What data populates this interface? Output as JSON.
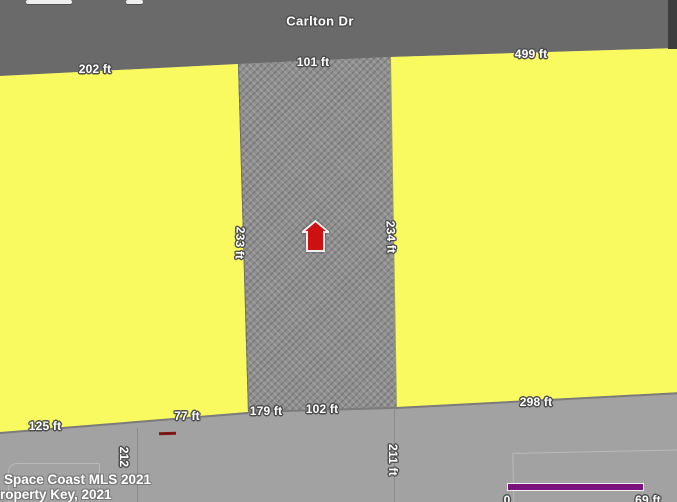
{
  "map": {
    "street": {
      "name": "Carlton Dr"
    },
    "measurements": {
      "top_left": "202 ft",
      "top_center": "101 ft",
      "top_right": "499 ft",
      "side_left": "233 ft",
      "side_right": "234 ft",
      "bottom_far_left": "125 ft",
      "bottom_left": "77 ft",
      "bottom_center_left": "179 ft",
      "bottom_center_right": "102 ft",
      "bottom_right": "298 ft",
      "lower_left_vertical": "212",
      "lower_center_vertical": "211 ft"
    },
    "watermark": {
      "line1": "Space Coast MLS 2021",
      "line2": "Property Key, 2021"
    },
    "scale_bar": {
      "min_label": "0",
      "max_label": "69 ft"
    },
    "colors": {
      "road_gray": "#6a6a6a",
      "parcel_yellow": "#f9f960",
      "hatched_parcel_gray": "#8f8f8f",
      "ground_gray": "#a2a2a2",
      "house_marker_red": "#cc1111",
      "scale_bar_purple": "#7c107c",
      "label_text": "#ffffff"
    },
    "icons": {
      "house_marker": "house-icon"
    }
  }
}
